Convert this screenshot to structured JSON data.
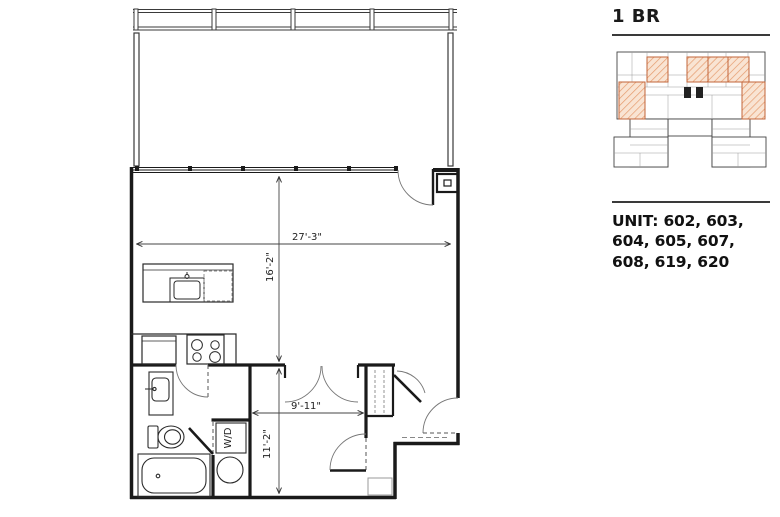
{
  "panel": {
    "title": "1 BR",
    "units_label": "UNIT: 602, 603, 604, 605, 607, 608, 619, 620"
  },
  "floorplan": {
    "dim_living_width": "27'-3\"",
    "dim_living_depth": "16'-2\"",
    "dim_bedroom_width": "9'-11\"",
    "dim_bedroom_depth": "11'-2\"",
    "washer_dryer_label": "W/D"
  },
  "colors": {
    "line": "#1a1a1a",
    "highlight_fill": "#f9e4d3",
    "highlight_hatch": "#e59b6e",
    "highlight_border": "#c2653a"
  }
}
